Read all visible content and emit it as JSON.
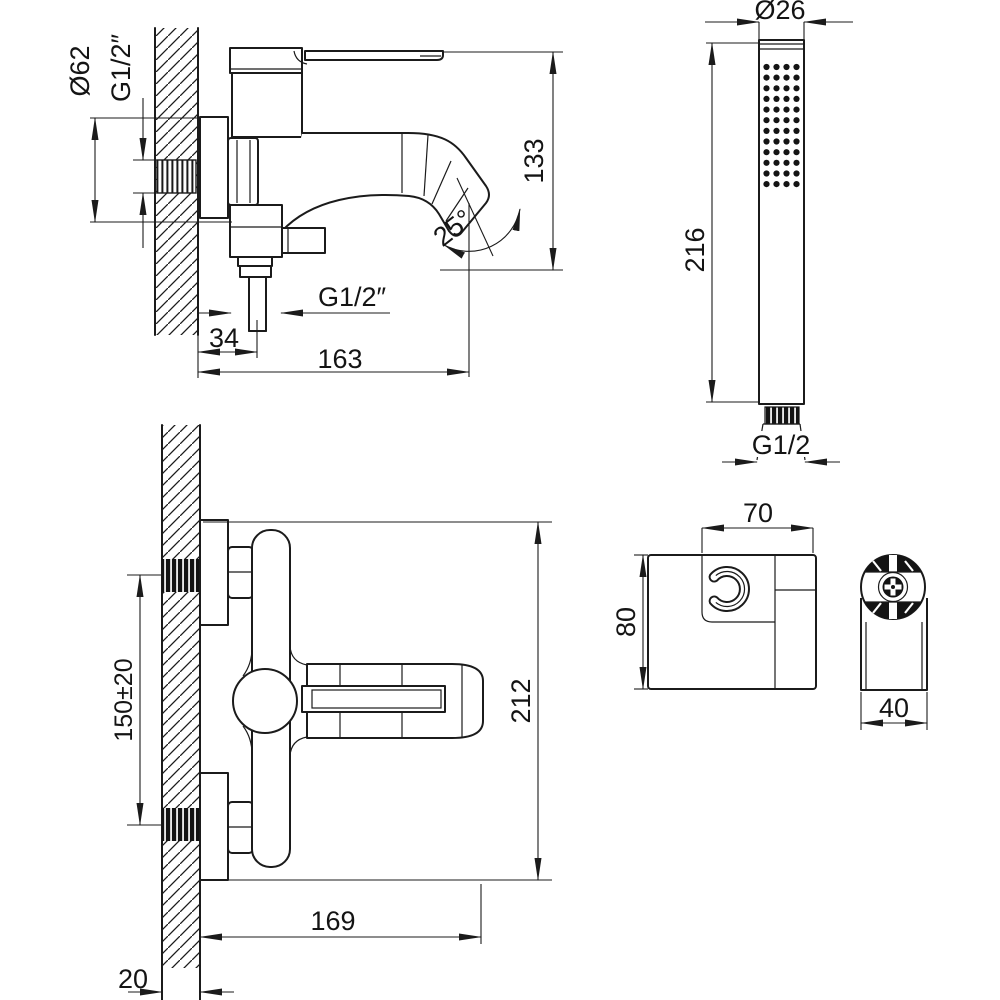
{
  "drawing": {
    "background": "#ffffff",
    "line_color": "#1b1b1b",
    "views": {
      "mixer_side": {
        "labels": {
          "flange_diameter": "Ø62",
          "wall_thread": "G1/2″",
          "height": "133",
          "spout_angle": "25°",
          "hose_thread": "G1/2″",
          "hose_offset": "34",
          "depth": "163"
        }
      },
      "hand_shower": {
        "labels": {
          "head_diameter": "Ø26",
          "length": "216",
          "thread": "G1/2"
        }
      },
      "mixer_front": {
        "labels": {
          "mounting_centers": "150±20",
          "height": "212",
          "width": "169",
          "wall_thickness": "20"
        }
      },
      "holder": {
        "labels": {
          "width": "70",
          "height": "80",
          "depth": "40"
        }
      }
    }
  }
}
